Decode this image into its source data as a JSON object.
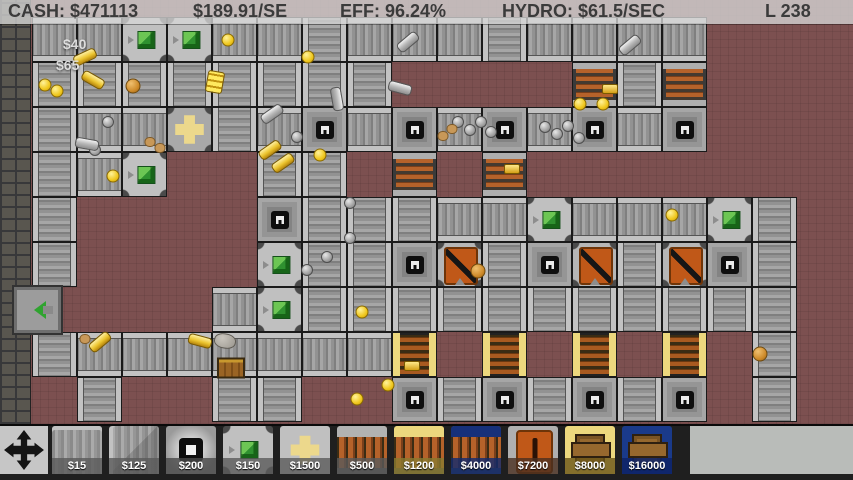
{
  "hud": {
    "cash": "CASH: $471113",
    "income": "$189.91/SE",
    "efficiency": "EFF: 96.24%",
    "hydro": "HYDRO: $61.5/SEC",
    "level": "L 238"
  },
  "popups": [
    {
      "text": "$40",
      "x": 63,
      "y": 36
    },
    {
      "text": "$65",
      "x": 56,
      "y": 57
    }
  ],
  "grid": {
    "tile_size": 45,
    "x0": 32,
    "y0": 17,
    "legend": {
      ".": "empty",
      "h": "conveyor-h",
      "v": "conveyor-v",
      "d": "drill",
      "g": "seller",
      "p": "cross-junction",
      "c": "copper-smelter",
      "f": "gold-smelter",
      "o": "crusher"
    },
    "rows": [
      "hhgghhvhhhvhhhh...",
      "vvvvvvvv....cvc...",
      "vhhpvhdhdhdhdhd...",
      "vhg..vv.c.c.......",
      "v....dvvvhhghhhgv.",
      "v....gvvdovdovodv.",
      "....hgvvvvvvvvvvv.",
      "vhhhhhhhf.f.f.f.v.",
      ".v..vv..dvdvdvd.v."
    ]
  },
  "exit_machine": {
    "x": 14,
    "y": 287
  },
  "items": [
    {
      "t": "coin",
      "x": 228,
      "y": 40
    },
    {
      "t": "coin",
      "x": 308,
      "y": 57
    },
    {
      "t": "coin",
      "x": 45,
      "y": 85
    },
    {
      "t": "coin",
      "x": 57,
      "y": 91
    },
    {
      "t": "coin",
      "x": 113,
      "y": 176
    },
    {
      "t": "coin",
      "x": 320,
      "y": 155
    },
    {
      "t": "coin",
      "x": 362,
      "y": 312
    },
    {
      "t": "coin",
      "x": 388,
      "y": 385
    },
    {
      "t": "coin",
      "x": 357,
      "y": 399
    },
    {
      "t": "coin",
      "x": 580,
      "y": 104
    },
    {
      "t": "coin",
      "x": 603,
      "y": 104
    },
    {
      "t": "coin",
      "x": 672,
      "y": 215
    },
    {
      "t": "ccoin",
      "x": 133,
      "y": 86
    },
    {
      "t": "ccoin",
      "x": 478,
      "y": 271
    },
    {
      "t": "ccoin",
      "x": 760,
      "y": 354
    },
    {
      "t": "ball",
      "x": 297,
      "y": 137
    },
    {
      "t": "ball",
      "x": 350,
      "y": 203
    },
    {
      "t": "ball",
      "x": 350,
      "y": 238
    },
    {
      "t": "ball",
      "x": 458,
      "y": 122
    },
    {
      "t": "ball",
      "x": 470,
      "y": 130
    },
    {
      "t": "ball",
      "x": 481,
      "y": 122
    },
    {
      "t": "ball",
      "x": 491,
      "y": 132
    },
    {
      "t": "ball",
      "x": 545,
      "y": 127
    },
    {
      "t": "ball",
      "x": 557,
      "y": 134
    },
    {
      "t": "ball",
      "x": 568,
      "y": 126
    },
    {
      "t": "ball",
      "x": 579,
      "y": 138
    },
    {
      "t": "ball",
      "x": 108,
      "y": 122
    },
    {
      "t": "ball",
      "x": 95,
      "y": 150
    },
    {
      "t": "ball",
      "x": 307,
      "y": 270
    },
    {
      "t": "ball",
      "x": 327,
      "y": 257
    },
    {
      "t": "sbar",
      "x": 408,
      "y": 42,
      "r": -40
    },
    {
      "t": "sbar",
      "x": 400,
      "y": 88,
      "r": 15
    },
    {
      "t": "sbar",
      "x": 272,
      "y": 114,
      "r": -35
    },
    {
      "t": "sbar",
      "x": 337,
      "y": 99,
      "r": 80
    },
    {
      "t": "sbar",
      "x": 87,
      "y": 144,
      "r": 10
    },
    {
      "t": "sbar",
      "x": 630,
      "y": 45,
      "r": -40
    },
    {
      "t": "gbar",
      "x": 85,
      "y": 57,
      "r": -25
    },
    {
      "t": "gbar",
      "x": 93,
      "y": 80,
      "r": 30
    },
    {
      "t": "gbar",
      "x": 270,
      "y": 150,
      "r": -35
    },
    {
      "t": "gbar",
      "x": 283,
      "y": 163,
      "r": -35
    },
    {
      "t": "gbar",
      "x": 100,
      "y": 342,
      "r": -40
    },
    {
      "t": "gbar",
      "x": 200,
      "y": 341,
      "r": 15
    },
    {
      "t": "ingot",
      "x": 412,
      "y": 366
    },
    {
      "t": "ingot",
      "x": 610,
      "y": 89
    },
    {
      "t": "ingot",
      "x": 512,
      "y": 169
    },
    {
      "t": "stack",
      "x": 215,
      "y": 82,
      "r": 10
    },
    {
      "t": "nug",
      "x": 150,
      "y": 142
    },
    {
      "t": "nug",
      "x": 160,
      "y": 148
    },
    {
      "t": "nug",
      "x": 443,
      "y": 136
    },
    {
      "t": "nug",
      "x": 452,
      "y": 129
    },
    {
      "t": "nug",
      "x": 85,
      "y": 339
    },
    {
      "t": "rock",
      "x": 225,
      "y": 341,
      "r": 10
    },
    {
      "t": "crate",
      "x": 231,
      "y": 368
    }
  ],
  "toolbar": {
    "move_tool": "move-tool",
    "items": [
      {
        "name": "conveyor",
        "price": "$15",
        "label_bg": "#5a5a5acc"
      },
      {
        "name": "conveyor-corner",
        "price": "$125",
        "label_bg": "#5a5a5acc"
      },
      {
        "name": "wall-block",
        "price": "$200",
        "label_bg": "#4a4a4acc"
      },
      {
        "name": "seller",
        "price": "$150",
        "label_bg": "#5a5a5acc"
      },
      {
        "name": "cross-junction",
        "price": "$1500",
        "label_bg": "#5a5a5acc"
      },
      {
        "name": "copper-smelter",
        "price": "$500",
        "label_bg": "#5a5a5acc"
      },
      {
        "name": "gold-smelter",
        "price": "$1200",
        "label_bg": "#8a7a30cc"
      },
      {
        "name": "blue-smelter",
        "price": "$4000",
        "label_bg": "#122a6ecc"
      },
      {
        "name": "crusher",
        "price": "$7200",
        "label_bg": "#4a3020cc"
      },
      {
        "name": "gold-warehouse",
        "price": "$8000",
        "label_bg": "#6a5518cc"
      },
      {
        "name": "blue-warehouse",
        "price": "$16000",
        "label_bg": "#0e2468dd"
      }
    ]
  },
  "colors": {
    "floor": "#7c5050",
    "belt_rail": "#c2c2c2",
    "hud_text": "#3b3b3b",
    "coil_orange": "#b5622a",
    "seller_green": "#2f9130",
    "gold_cap": "#ecd87e",
    "blue_cap": "#16307a",
    "crusher_orange": "#c05818"
  }
}
